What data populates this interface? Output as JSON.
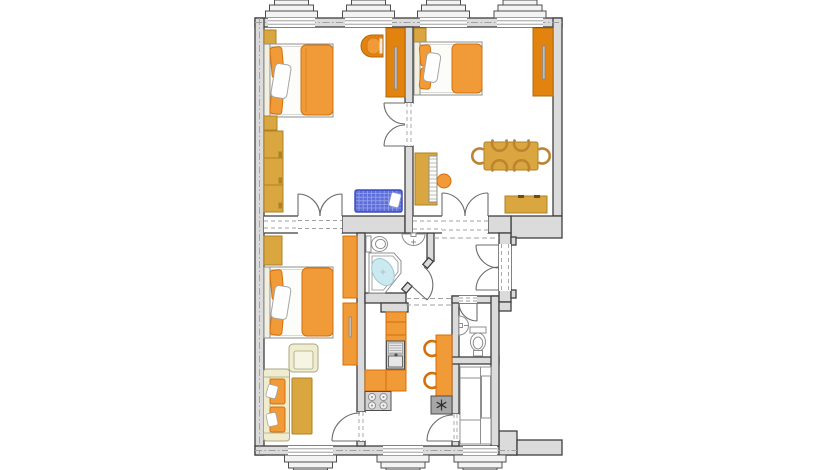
{
  "palette": {
    "white": "#FFFFFF",
    "wall_fill": "#DBDBDB",
    "wall_stroke": "#3F3F3F",
    "window_fill": "#F3F3F3",
    "dash_gray": "#A0A0A0",
    "door_gray": "#6B6B6B",
    "fixture_stroke": "#8F8F8F",
    "bed_frame": "#FCFCF8",
    "headboard": "#F1EFDF",
    "orange": "#F09A38",
    "orange_edge": "#D4700A",
    "orange_dark": "#E2830F",
    "orange_dark_edge": "#B2690A",
    "ochre": "#D9A63F",
    "ochre_edge": "#AE8126",
    "cream": "#EFEDCE",
    "cream_edge": "#A8A687",
    "cream_inner": "#F6F4E2",
    "crib_blue": "#5E6ED8",
    "crib_edge": "#3D4FC0",
    "crib_grid": "#97A3EC",
    "water": "#CCE9F0",
    "water_edge": "#9BC7D3",
    "steel": "#D2D2D2",
    "steel_light": "#E6E6E6",
    "steel_dark": "#A6A6A6",
    "appliance_edge": "#4F4F4F",
    "burner": "#EFEFEF",
    "handle": "#BDBDBD",
    "knob_dark": "#6B4E12",
    "chair_stroke": "#BE8330",
    "snowflake": "#2E2E2E"
  },
  "plan": {
    "type": "apartment-floor-plan",
    "rooms": [
      {
        "name": "bedroom-top-left",
        "furniture": [
          "nightstand",
          "double-bed",
          "wall-cabinet",
          "dresser",
          "armchair",
          "tv-wardrobe",
          "baby-cot"
        ]
      },
      {
        "name": "living-dining-top-right",
        "furniture": [
          "nightstand",
          "double-bed",
          "wardrobe",
          "piano",
          "piano-stool",
          "dining-table",
          "dining-chairs-x6",
          "sideboard"
        ]
      },
      {
        "name": "bedroom-living-bottom-left",
        "furniture": [
          "wardrobe",
          "double-bed",
          "wall-cabinet-x2",
          "armchair",
          "sofa",
          "coffee-table"
        ]
      },
      {
        "name": "bathroom",
        "furniture": [
          "toilet",
          "washbasin",
          "corner-bathtub"
        ]
      },
      {
        "name": "kitchen",
        "furniture": [
          "counter",
          "kitchen-sink",
          "stove",
          "freezer",
          "kitchen-table",
          "chairs-x2"
        ]
      },
      {
        "name": "wc",
        "furniture": [
          "washbasin",
          "toilet"
        ]
      },
      {
        "name": "pantry",
        "furniture": [
          "shelving"
        ]
      },
      {
        "name": "hallway",
        "furniture": []
      }
    ],
    "windows": {
      "top_wall": 4,
      "bottom_wall": 3
    },
    "doors": {
      "double_interior": 3,
      "single_interior": 5,
      "entrance": "double-leaf"
    }
  }
}
